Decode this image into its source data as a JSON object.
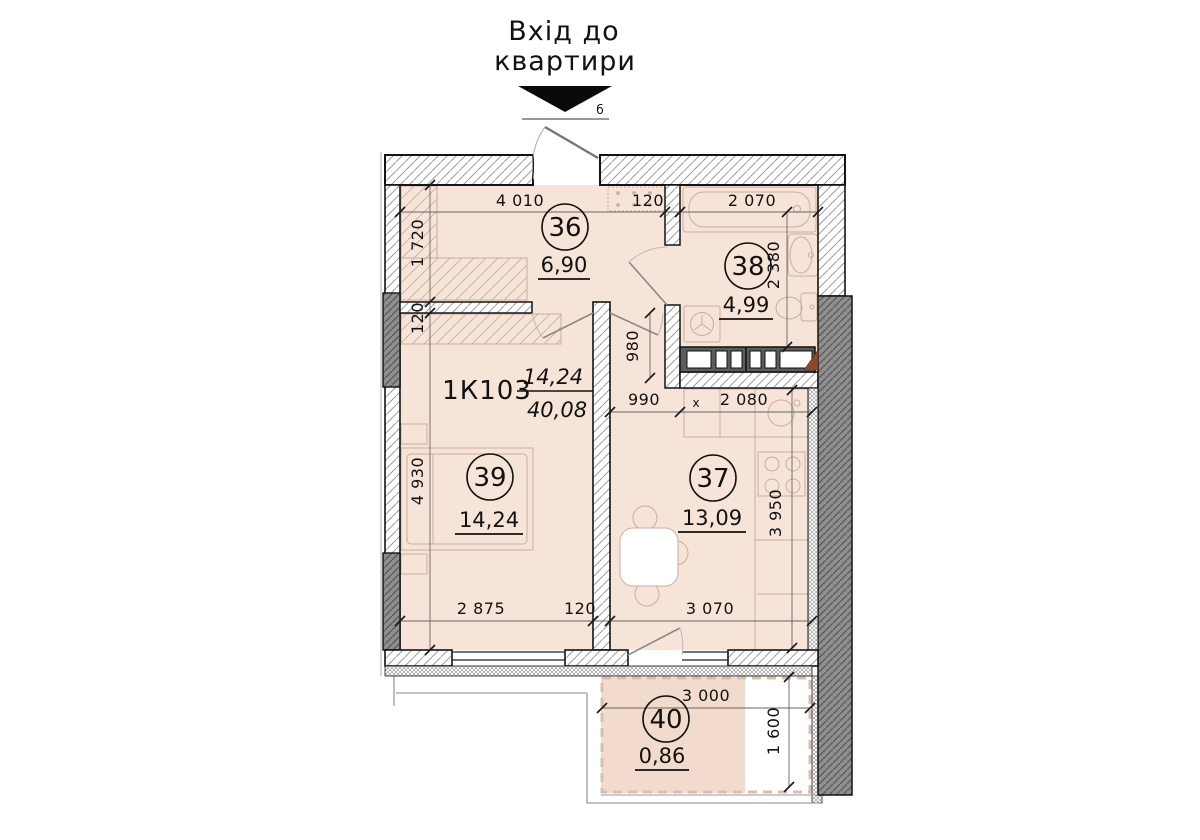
{
  "entrance": {
    "line1": "Вхід до",
    "line2": "квартири",
    "door_mark": "б"
  },
  "apartment": {
    "code": "1К103",
    "living_area": "14,24",
    "total_area": "40,08"
  },
  "rooms": {
    "r36": {
      "number": "36",
      "area": "6,90"
    },
    "r38": {
      "number": "38",
      "area": "4,99"
    },
    "r39": {
      "number": "39",
      "area": "14,24"
    },
    "r37": {
      "number": "37",
      "area": "13,09"
    },
    "r40": {
      "number": "40",
      "area": "0,86"
    }
  },
  "dimensions": {
    "hall_width": "4 010",
    "wall_36_38": "120",
    "bath_width": "2 070",
    "hall_height": "1 720",
    "wall_36_39": "120",
    "room39_height": "4 930",
    "bath_height": "2 380",
    "corridor_height": "980",
    "corridor_width": "990",
    "chain_mark": "x",
    "kitchen_top_width": "2 080",
    "kitchen_height": "3 950",
    "room39_width": "2 875",
    "wall_39_37": "120",
    "kitchen_width": "3 070",
    "balcony_width": "3 000",
    "balcony_height": "1 600"
  },
  "colors": {
    "room_fill": "#f7e4d9",
    "balcony_fill": "#f2dbcc",
    "wall_dark": "#8e8e8e",
    "wood": "#8a4a2a"
  }
}
